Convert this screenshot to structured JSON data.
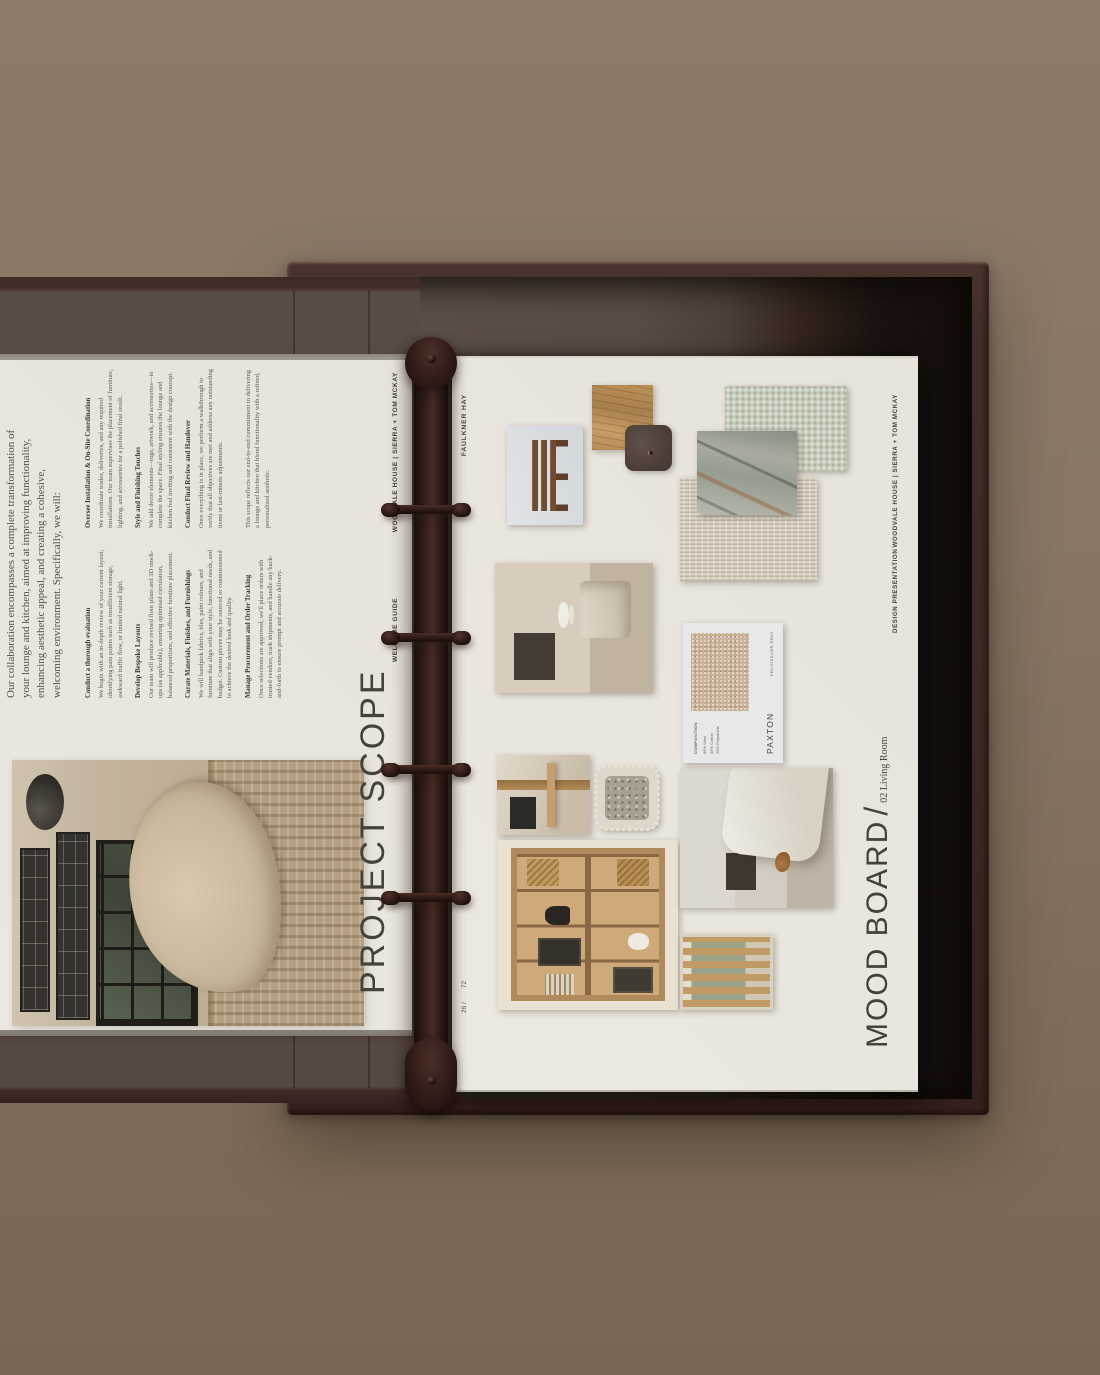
{
  "colors": {
    "background": "#887765",
    "binder_cover": "#3f2b27",
    "binder_interior": "#594c42",
    "page": "#eae6df",
    "ink": "#45403a",
    "body_text": "#5c564e"
  },
  "left_page": {
    "intro": "Our collaboration encompasses a complete transformation of your lounge and kitchen, aimed at improving functionality, enhancing aesthetic appeal, and creating a cohesive, welcoming environment. Specifically, we will:",
    "col1": [
      {
        "heading": "Conduct a thorough evaluation",
        "body": "We begin with an in-depth review of your current layout, identifying pain points such as insufficient storage, awkward traffic flow, or limited natural light."
      },
      {
        "heading": "Develop Bespoke Layouts",
        "body": "Our team will produce revised floor plans and 3D mock-ups (as applicable), ensuring optimised circulation, balanced proportions, and effective furniture placement."
      },
      {
        "heading": "Curate Materials, Finishes, and Furnishings",
        "body": "We will handpick fabrics, tiles, paint colours, and furniture that align with your style, functional needs, and budget. Custom pieces may be sourced or commissioned to achieve the desired look and quality."
      },
      {
        "heading": "Manage Procurement and Order Tracking",
        "body": "Once selections are approved, we'll place orders with trusted vendors, track shipments, and handle any back-and-forth to ensure prompt and accurate delivery."
      }
    ],
    "col2": [
      {
        "heading": "Oversee Installation & On-Site Coordination",
        "body": "We coordinate trades, deliveries, and any required installations. Our team supervises the placement of furniture, lighting, and accessories for a polished final result."
      },
      {
        "heading": "Style and Finishing Touches",
        "body": "We add decor elements—rugs, artwork, and accessories—to complete the space. Final styling ensures the lounge and kitchen feel inviting and consistent with the design concept."
      },
      {
        "heading": "Conduct Final Review and Handover",
        "body": "Once everything is in place, we perform a walkthrough to verify that all objectives are met and address any outstanding items or last-minute adjustments."
      },
      {
        "heading": "",
        "body": "This scope reflects our end-to-end commitment to delivering a lounge and kitchen that blend functionality with a refined, personalised aesthetic."
      }
    ],
    "title": "PROJECT SCOPE",
    "footer_label": "WELCOME GUIDE",
    "footer_project": "WOODVALE HOUSE | SIERRA + TOM MCKAY"
  },
  "right_page": {
    "page_number": "26 /",
    "page_total": "72",
    "brand": "FAULKNER HAY",
    "title": "MOOD BOARD",
    "title_slash": "/",
    "subtitle": "02 Living Room",
    "footer_label": "DESIGN PRESENTATION",
    "footer_project": "WOODVALE HOUSE | SIERRA + TOM MCKAY",
    "fabric_card": {
      "composition_label": "COMPOSITION",
      "composition_1": "45% Wool",
      "composition_2": "35% Cotton",
      "composition_3": "20% Polyamide",
      "name": "PAXTON",
      "code": "FELIX/SILVER GRAY"
    }
  }
}
